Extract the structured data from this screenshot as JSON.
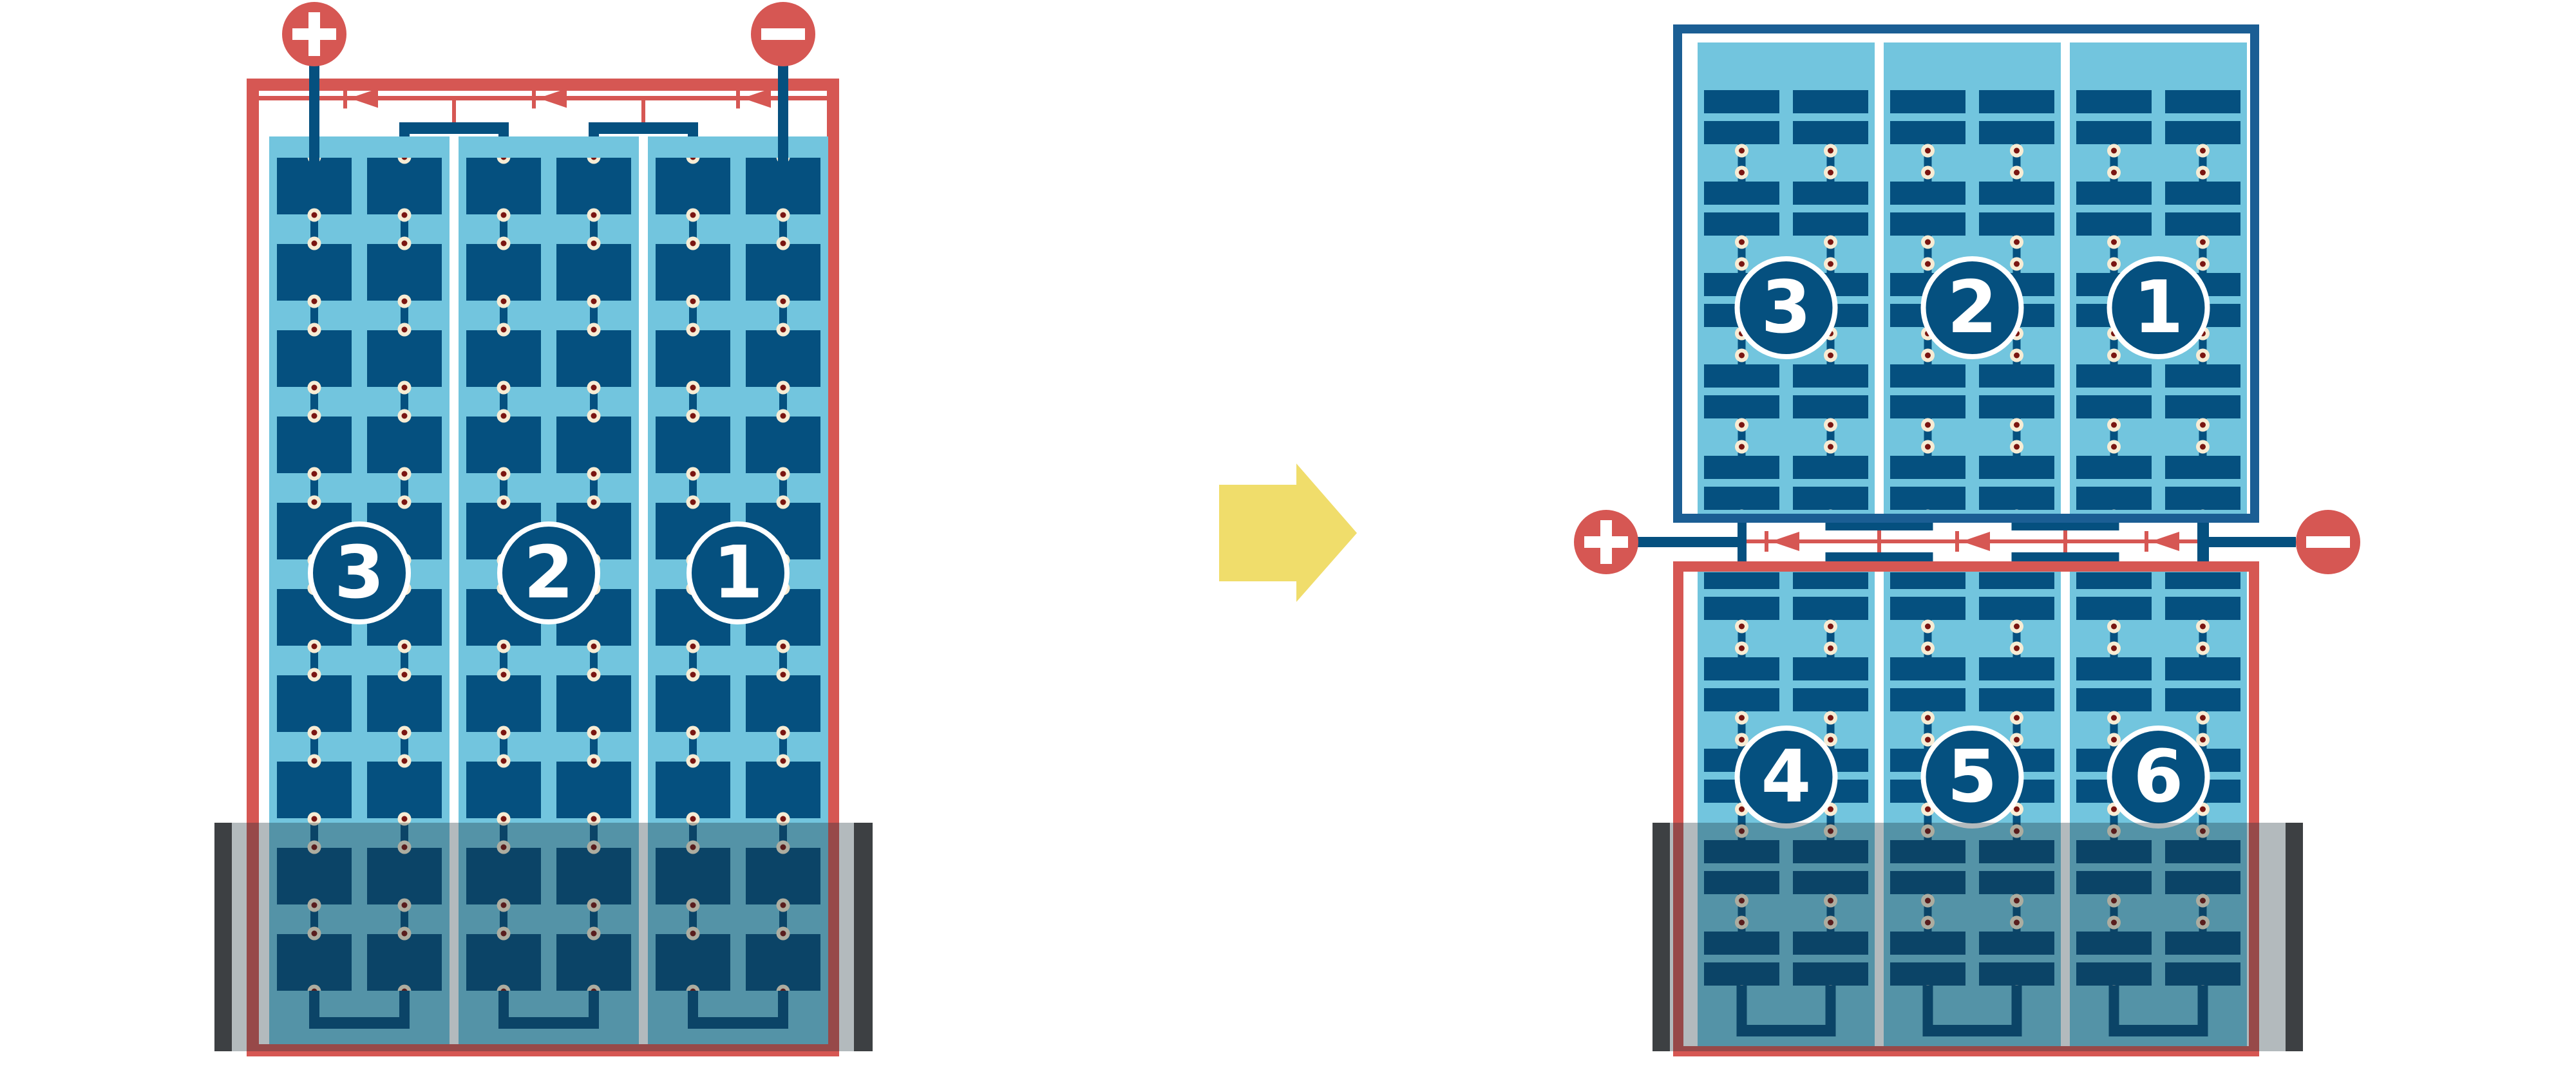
{
  "diagram_type": "solar-panel-series-wiring-comparison",
  "colors": {
    "coral_red": "#d65753",
    "navy_cell": "#05507f",
    "frame_blue": "#1b5e94",
    "light_blue": "#72c5de",
    "solder_pad_cream": "#f7ecd4",
    "solder_pad_core": "#7a1511",
    "shade_overlay": "rgba(25,45,55,0.33)",
    "shade_bar": "#3d4043",
    "arrow_yellow": "#f0dd6b"
  },
  "left_assembly": {
    "positive_label": "+",
    "negative_label": "−",
    "modules": [
      {
        "label": "3"
      },
      {
        "label": "2"
      },
      {
        "label": "1"
      }
    ]
  },
  "right_assembly": {
    "positive_label": "+",
    "negative_label": "−",
    "top_panel_modules": [
      {
        "label": "3"
      },
      {
        "label": "2"
      },
      {
        "label": "1"
      }
    ],
    "bottom_panel_modules": [
      {
        "label": "4"
      },
      {
        "label": "5"
      },
      {
        "label": "6"
      }
    ]
  }
}
